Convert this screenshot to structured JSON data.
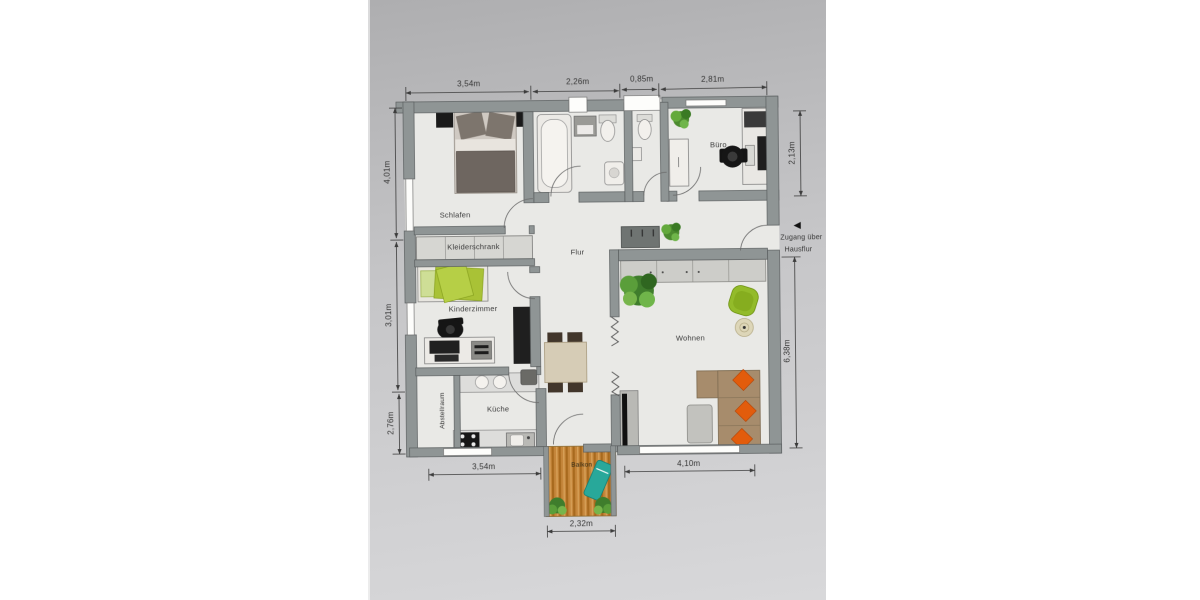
{
  "photo": {
    "rooms": {
      "schlafen": "Schlafen",
      "kleiderschrank": "Kleiderschrank",
      "kinderzimmer": "Kinderzimmer",
      "flur": "Flur",
      "buero": "Büro",
      "wohnen": "Wohnen",
      "kueche": "Küche",
      "abstellraum": "Abstellraum",
      "balkon": "Balkon"
    },
    "dims": {
      "top": [
        "3,54m",
        "2,26m",
        "0,85m",
        "2,81m"
      ],
      "left": [
        "4,01m",
        "3,01m",
        "2,76m"
      ],
      "right": [
        "2,13m",
        "6,38m"
      ],
      "bottom": [
        "3,54m",
        "4,10m",
        "2,32m"
      ]
    },
    "entrance_note": {
      "line1": "Zugang über",
      "line2": "Hausflur",
      "arrow": "◄"
    },
    "colors": {
      "wall": "#8f9595",
      "wood": "#c5863b",
      "accent_green": "#a9c236",
      "accent_orange": "#e25c0c"
    }
  }
}
